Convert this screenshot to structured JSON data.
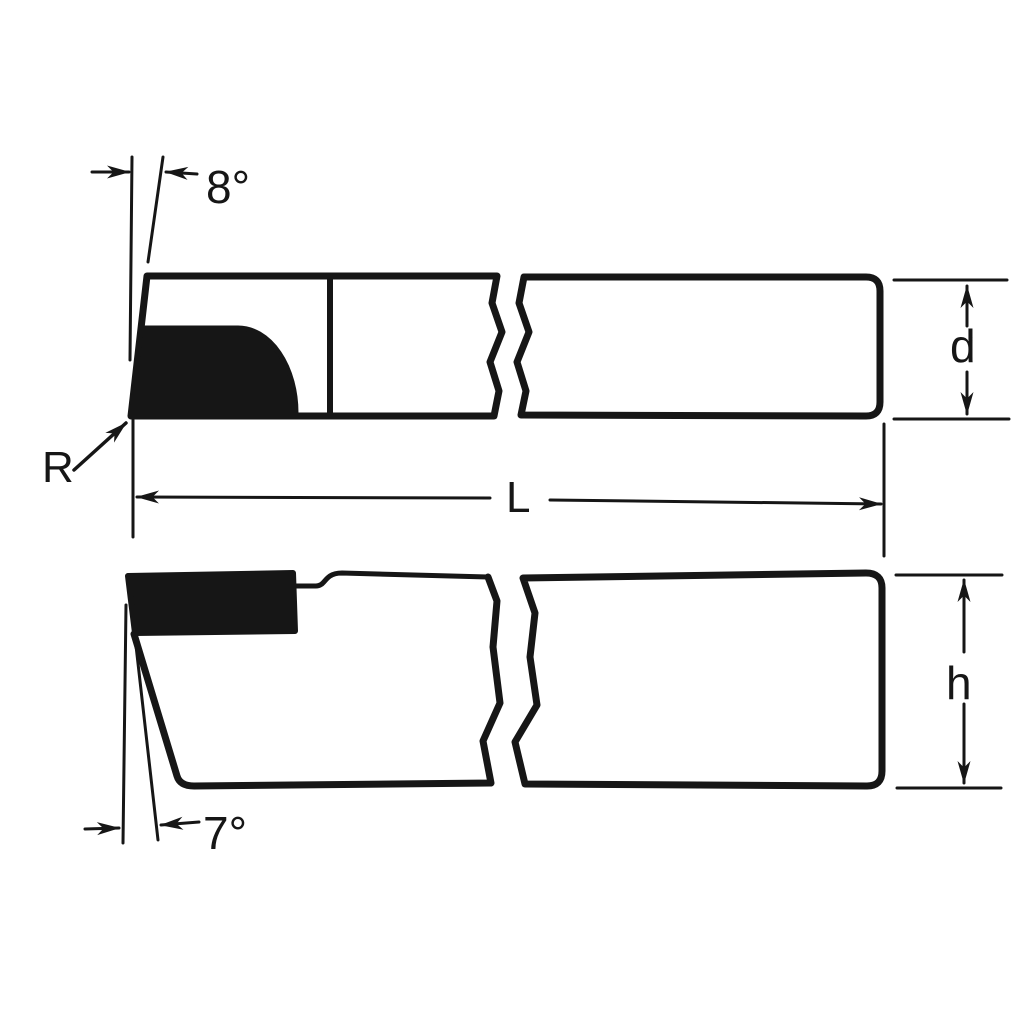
{
  "drawing": {
    "ink_color": "#161616",
    "background_color": "#ffffff",
    "top_view": {
      "back_rake_angle_label": "8°",
      "nose_radius_label": "R",
      "overall_length_label": "L",
      "shank_width_label": "d"
    },
    "side_view": {
      "front_clearance_angle_label": "7°",
      "shank_height_label": "h"
    }
  }
}
